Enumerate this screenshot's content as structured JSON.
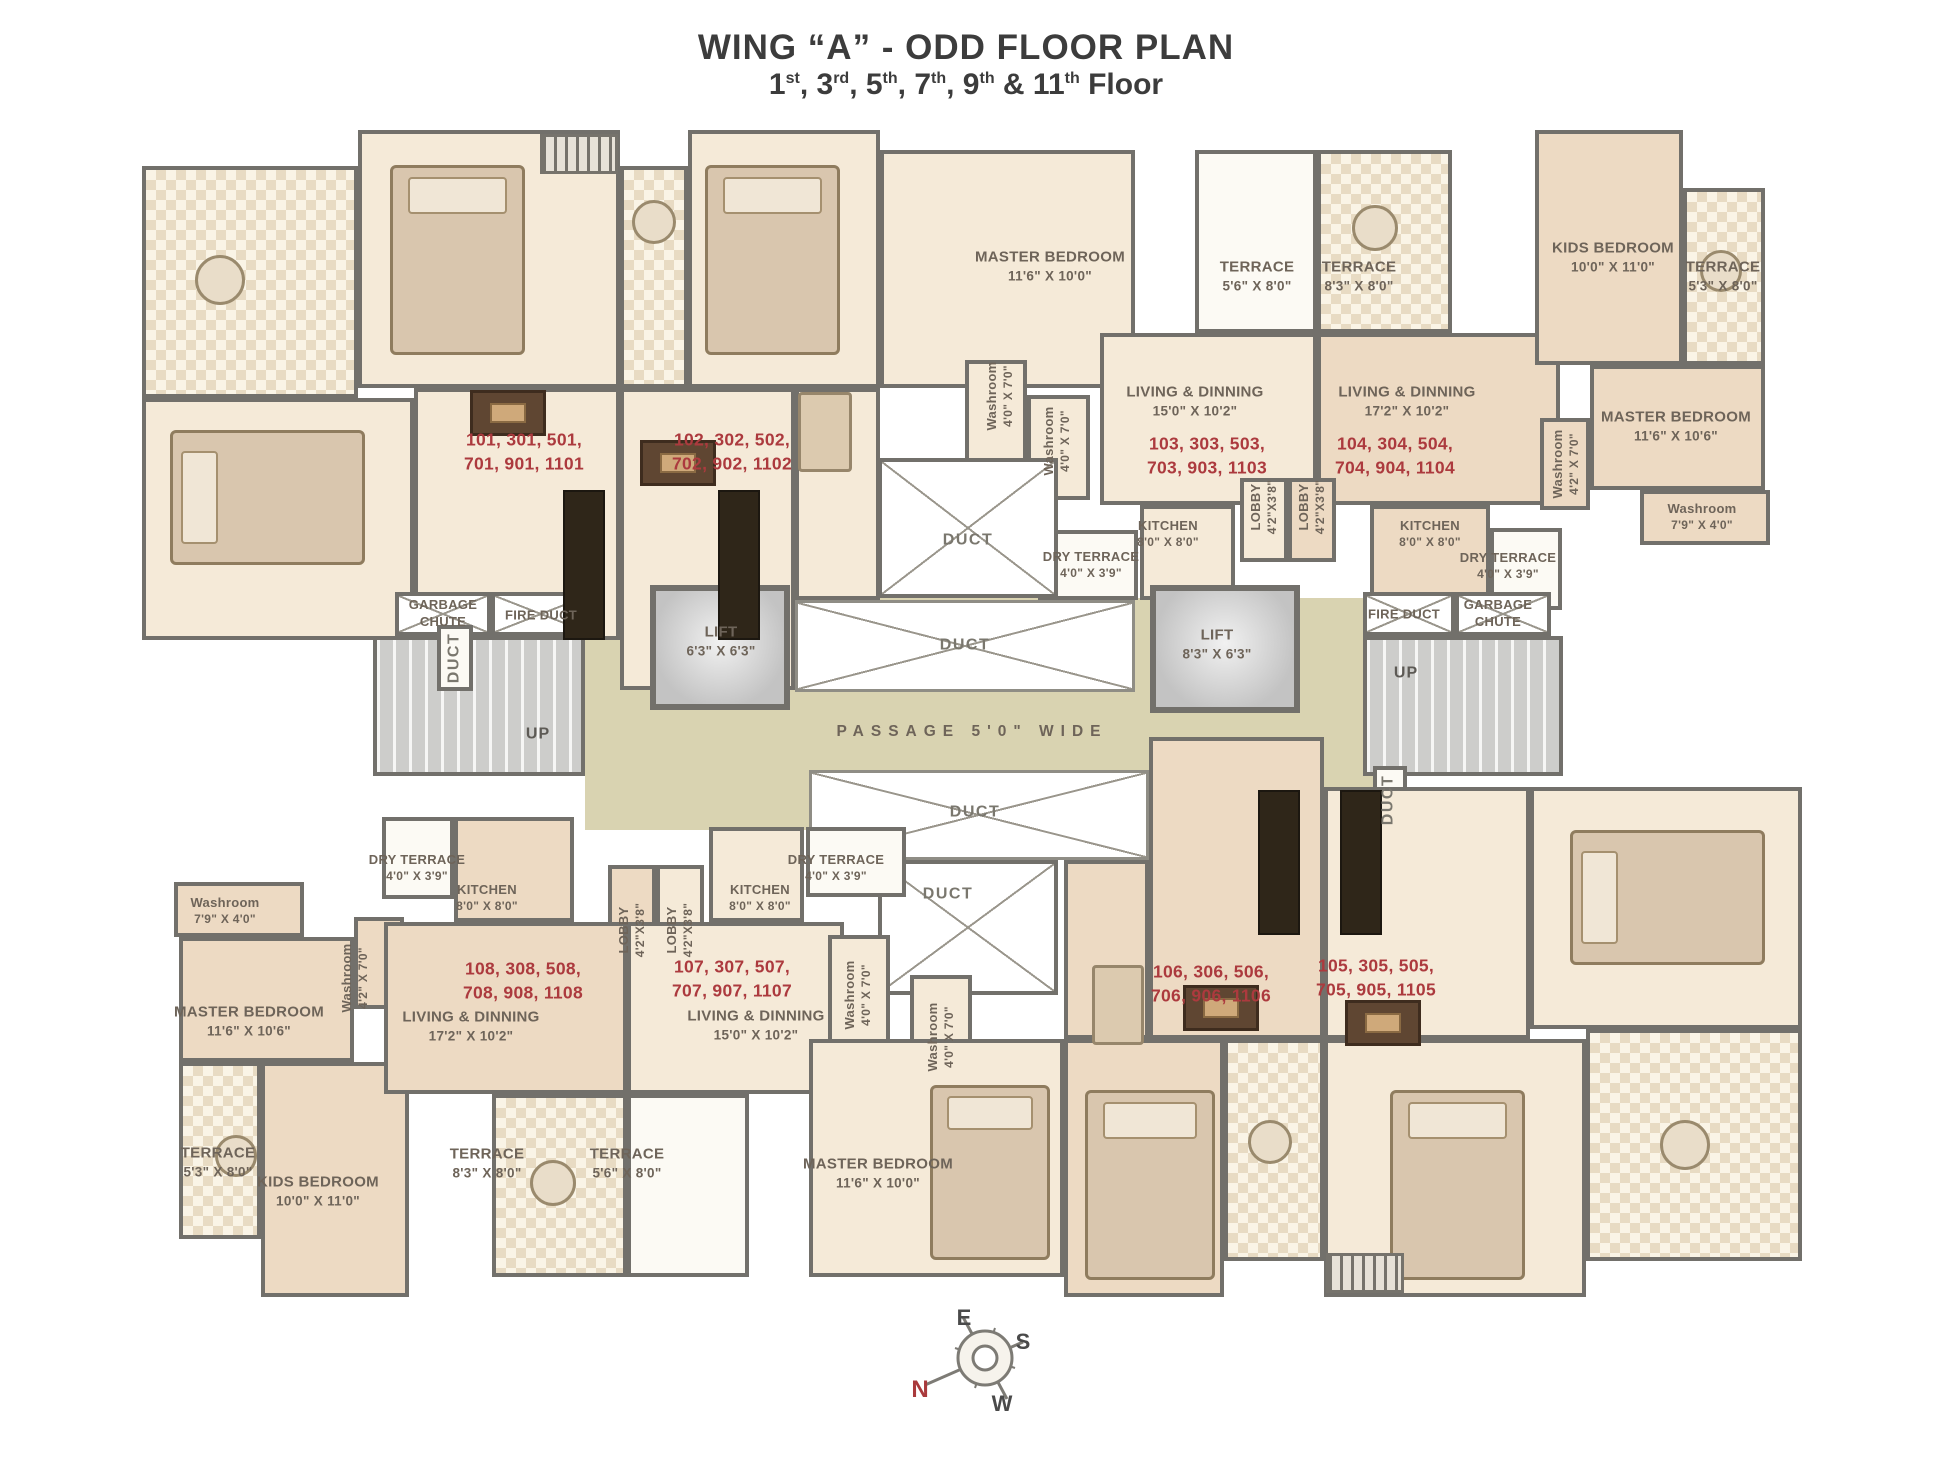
{
  "title": "WING “A” - ODD FLOOR PLAN",
  "subtitle": {
    "plain": "1st, 3rd, 5th, 7th, 9th & 11th Floor",
    "segments": [
      {
        "t": "1"
      },
      {
        "s": "st"
      },
      {
        "t": ", 3"
      },
      {
        "s": "rd"
      },
      {
        "t": ", 5"
      },
      {
        "s": "th"
      },
      {
        "t": ", 7"
      },
      {
        "s": "th"
      },
      {
        "t": ", 9"
      },
      {
        "s": "th"
      },
      {
        "t": " & 11"
      },
      {
        "s": "th"
      },
      {
        "t": " Floor"
      }
    ]
  },
  "rooms": {
    "master_bedroom_a": {
      "name": "MASTER BEDROOM",
      "dims": "11'6\" X 10'0\""
    },
    "master_bedroom_b": {
      "name": "MASTER BEDROOM",
      "dims": "11'6\" X 10'6\""
    },
    "kids_bedroom": {
      "name": "KIDS BEDROOM",
      "dims": "10'0\" X 11'0\""
    },
    "living_150": {
      "name": "LIVING & DINNING",
      "dims": "15'0\" X 10'2\""
    },
    "living_172": {
      "name": "LIVING & DINNING",
      "dims": "17'2\" X 10'2\""
    },
    "kitchen": {
      "name": "KITCHEN",
      "dims": "8'0\" X 8'0\""
    },
    "dry_terrace": {
      "name": "DRY TERRACE",
      "dims": "4'0\" X 3'9\""
    },
    "lobby": {
      "name": "LOBBY",
      "dims": "4'2\"X3'8\""
    },
    "washroom_40": {
      "name": "Washroom",
      "dims": "4'0\" X 7'0\""
    },
    "washroom_42": {
      "name": "Washroom",
      "dims": "4'2\" X 7'0\""
    },
    "washroom_79": {
      "name": "Washroom",
      "dims": "7'9\" X 4'0\""
    },
    "terrace_56": {
      "name": "TERRACE",
      "dims": "5'6\" X 8'0\""
    },
    "terrace_83": {
      "name": "TERRACE",
      "dims": "8'3\" X 8'0\""
    },
    "terrace_53": {
      "name": "TERRACE",
      "dims": "5'3\" X 8'0\""
    },
    "lift_small": {
      "name": "LIFT",
      "dims": "6'3\" X 6'3\""
    },
    "lift_large": {
      "name": "LIFT",
      "dims": "8'3\" X 6'3\""
    },
    "garbage_chute": {
      "line1": "GARBAGE",
      "line2": "CHUTE"
    },
    "fire_duct": "FIRE DUCT",
    "duct": "DUCT",
    "passage": "PASSAGE 5'0\" WIDE",
    "up": "UP"
  },
  "units": {
    "u101": {
      "line1": "101, 301, 501,",
      "line2": "701, 901, 1101"
    },
    "u102": {
      "line1": "102, 302, 502,",
      "line2": "702, 902, 1102"
    },
    "u103": {
      "line1": "103, 303, 503,",
      "line2": "703, 903, 1103"
    },
    "u104": {
      "line1": "104, 304, 504,",
      "line2": "704, 904, 1104"
    },
    "u105": {
      "line1": "105, 305, 505,",
      "line2": "705, 905, 1105"
    },
    "u106": {
      "line1": "106, 306, 506,",
      "line2": "706, 906, 1106"
    },
    "u107": {
      "line1": "107, 307, 507,",
      "line2": "707, 907, 1107"
    },
    "u108": {
      "line1": "108, 308, 508,",
      "line2": "708, 908, 1108"
    }
  },
  "compass": {
    "n": "N",
    "e": "E",
    "s": "S",
    "w": "W"
  },
  "colors": {
    "wall": "#72706b",
    "unit_light": "#f5ead8",
    "unit_dark": "#eddac3",
    "corridor": "#d9d3b1",
    "unit_number_red": "#ac3a3e",
    "label": "#6e6459"
  }
}
